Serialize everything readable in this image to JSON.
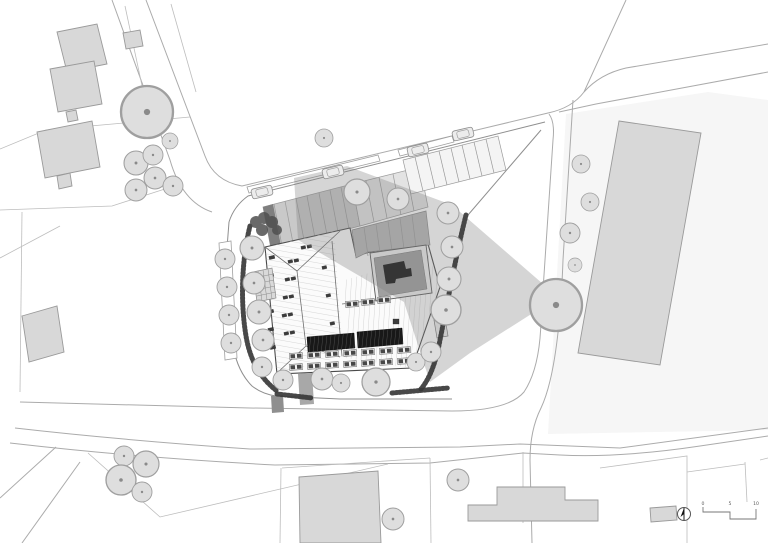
{
  "meta": {
    "drawing_type": "architectural site plan",
    "style": "grayscale line drawing, top view"
  },
  "scalebar": {
    "tick_labels": [
      "0",
      "5",
      "10"
    ]
  },
  "north_arrow": {
    "icon": "north-arrow-icon"
  },
  "palette": {
    "paper": "#ffffff",
    "road_line": "#ababab",
    "parcel_tint": "#f6f6f6",
    "context_building_fill": "#d8d8d8",
    "context_building_stroke": "#9a9a9a",
    "tree_fill": "#dedede",
    "tree_stroke": "#9f9f9f",
    "main_roof_fill": "#fbfbfb",
    "main_roof_stroke": "#4a4a4a",
    "carport_fill": "#c9c9c9",
    "carport_dark_cell": "#7f7f7f",
    "mid_roof_fill": "#b9b9b9",
    "courtyard_fill": "#a0a0a0",
    "court_structure_fill": "#141414",
    "solar_fill": "#181818",
    "skylight_fill": "#3c3c3c",
    "hedge_color": "#383838",
    "shadow_color": "#7d7d7d",
    "path_fill": "#a8a8a8"
  },
  "features": {
    "items": [
      "roads",
      "parcel lines",
      "context buildings",
      "deciduous trees",
      "main courtyard building with hip roofs",
      "rooftop solar arrays",
      "roof skylights",
      "parking bays",
      "parked cars",
      "perimeter hedges",
      "inner courtyard with play structure",
      "pergola trellis",
      "building shadow",
      "north arrow",
      "stepped scale bar"
    ]
  }
}
